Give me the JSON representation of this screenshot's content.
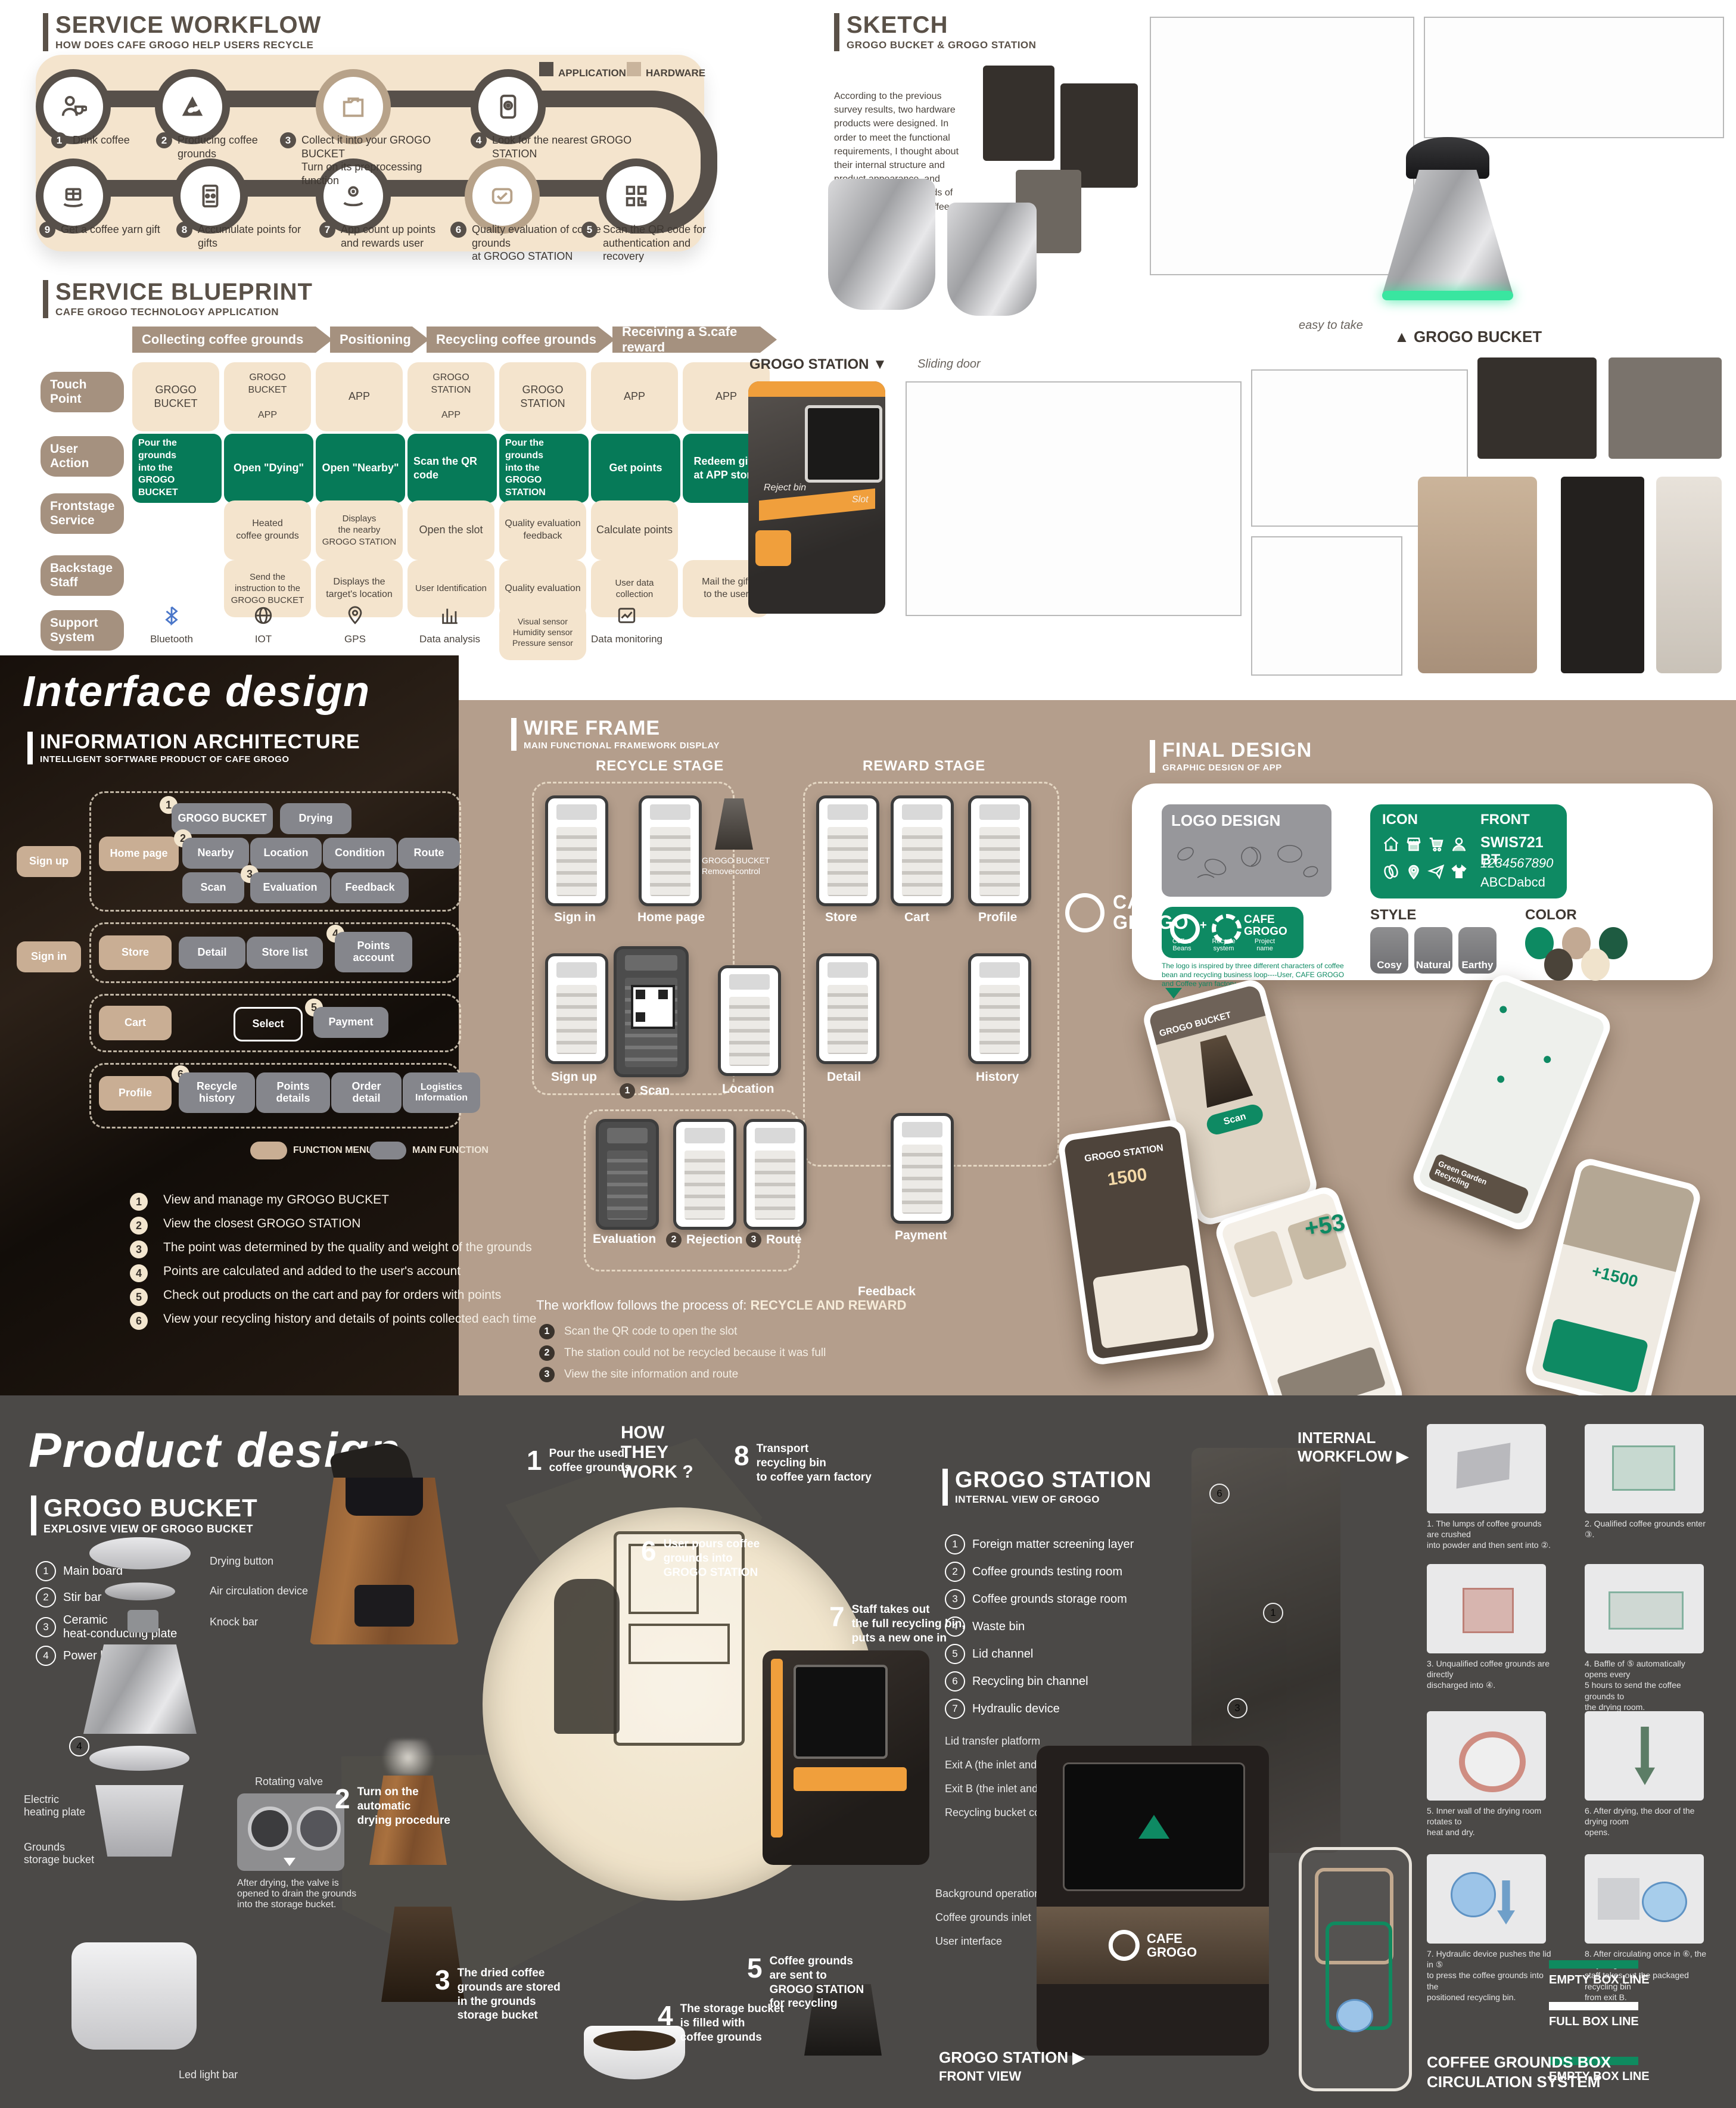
{
  "service_workflow": {
    "title": "SERVICE WORKFLOW",
    "subtitle": "HOW DOES CAFE GROGO HELP USERS RECYCLE",
    "legend": [
      {
        "label": "APPLICATION",
        "color": "#57504a"
      },
      {
        "label": "HARDWARE",
        "color": "#c9b49c"
      }
    ],
    "row1": [
      {
        "num": "1",
        "label": "Drink coffee"
      },
      {
        "num": "2",
        "label": "Producing coffee grounds"
      },
      {
        "num": "3",
        "label": "Collect it into your GROGO BUCKET\nTurn on its preprocessing function"
      },
      {
        "num": "4",
        "label": "Look for the nearest GROGO STATION"
      }
    ],
    "row2": [
      {
        "num": "9",
        "label": "Get a coffee yarn gift"
      },
      {
        "num": "8",
        "label": "Accumulate points for gifts"
      },
      {
        "num": "7",
        "label": "App count up points\nand rewards user"
      },
      {
        "num": "6",
        "label": "Quality evaluation of coffee grounds\nat GROGO STATION"
      },
      {
        "num": "5",
        "label": "Scan the QR code for\nauthentication and recovery"
      }
    ]
  },
  "service_blueprint": {
    "title": "SERVICE BLUEPRINT",
    "subtitle": "CAFE GROGO TECHNOLOGY APPLICATION",
    "phases": [
      "Collecting coffee grounds",
      "Positioning",
      "Recycling coffee grounds",
      "Receiving a S.cafe reward"
    ],
    "rows": [
      "Touch\nPoint",
      "User\nAction",
      "Frontstage\nService",
      "Backstage\nStaff",
      "Support\nSystem"
    ],
    "touch_point": [
      "GROGO\nBUCKET",
      "GROGO\nBUCKET\n\nAPP",
      "APP",
      "GROGO\nSTATION\n\nAPP",
      "GROGO\nSTATION",
      "APP",
      "APP"
    ],
    "user_action": [
      "Pour the grounds\ninto the\nGROGO BUCKET",
      "Open \"Dying\"",
      "Open \"Nearby\"",
      "Scan the QR code",
      "Pour the grounds\ninto the\nGROGO STATION",
      "Get points",
      "Redeem gifts\nat APP store"
    ],
    "frontstage": [
      "Heated\ncoffee grounds",
      "Displays\nthe nearby\nGROGO STATION",
      "Open the slot",
      "Quality evaluation\nfeedback",
      "Calculate points"
    ],
    "backstage": [
      "Send the\ninstruction to the\nGROGO BUCKET",
      "Displays the\ntarget's location",
      "User Identification",
      "Quality evaluation",
      "User data collection",
      "Mail the gift\nto the user"
    ],
    "support": [
      {
        "label": "Bluetooth"
      },
      {
        "label": "IOT"
      },
      {
        "label": "GPS"
      },
      {
        "label": "Data analysis"
      },
      {
        "label": "Visual sensor\nHumidity sensor\nPressure sensor"
      },
      {
        "label": "Data monitoring"
      }
    ]
  },
  "sketch": {
    "title": "SKETCH",
    "subtitle": "GROGO BUCKET & GROGO STATION",
    "paragraph": "According to the previous survey results, two hardware products were designed. In order to meet the functional requirements, I thought about their internal structure and product appearance, and determined their methods of drying and collecting coffee grounds.",
    "bucket_label": "▲  GROGO BUCKET",
    "station_label": "GROGO STATION ▼",
    "easy_to_take": "easy to take",
    "sliding_door": "Sliding door",
    "reject_bin": "Reject bin",
    "slot": "Slot"
  },
  "interface_design": {
    "heading": "Interface  design",
    "ia_title": "INFORMATION ARCHITECTURE",
    "ia_subtitle": "INTELLIGENT SOFTWARE PRODUCT OF CAFE GROGO",
    "nodes": {
      "sign_up": "Sign up",
      "sign_in": "Sign in",
      "home": "Home page",
      "bucket": "GROGO BUCKET",
      "drying": "Drying",
      "nearby": "Nearby",
      "location": "Location",
      "condition": "Condition",
      "route": "Route",
      "scan": "Scan",
      "evaluation": "Evaluation",
      "feedback": "Feedback",
      "store": "Store",
      "detail": "Detail",
      "store_list": "Store list",
      "points_account": "Points\naccount",
      "cart": "Cart",
      "select": "Select",
      "payment": "Payment",
      "profile": "Profile",
      "recycle_history": "Recycle\nhistory",
      "points_details": "Points\ndetails",
      "order_detail": "Order\ndetail",
      "logistics": "Logistics\nInformation"
    },
    "badges": [
      "1",
      "2",
      "3",
      "4",
      "5",
      "6"
    ],
    "legend": [
      {
        "label": "FUNCTION MENU"
      },
      {
        "label": "MAIN FUNCTION"
      }
    ],
    "notes": [
      {
        "num": "1",
        "text": "View and manage my GROGO BUCKET"
      },
      {
        "num": "2",
        "text": "View the closest GROGO STATION"
      },
      {
        "num": "3",
        "text": "The point was determined by the quality and weight of the grounds"
      },
      {
        "num": "4",
        "text": "Points are calculated and added to the user's account"
      },
      {
        "num": "5",
        "text": "Check out products on the cart and pay for orders with points"
      },
      {
        "num": "6",
        "text": "View your recycling history and details of points collected each time"
      }
    ]
  },
  "wireframe": {
    "title": "WIRE FRAME",
    "subtitle": "MAIN FUNCTIONAL FRAMEWORK DISPLAY",
    "recycle_stage": "RECYCLE STAGE",
    "reward_stage": "REWARD STAGE",
    "screens": {
      "sign_in": "Sign in",
      "home": "Home page",
      "sign_up": "Sign up",
      "scan": {
        "num": "1",
        "label": "Scan"
      },
      "location": "Location",
      "evaluation": "Evaluation",
      "rejection": {
        "num": "2",
        "label": "Rejection"
      },
      "route": {
        "num": "3",
        "label": "Route"
      },
      "store": "Store",
      "cart": "Cart",
      "profile": "Profile",
      "detail": "Detail",
      "history": "History",
      "payment": "Payment",
      "feedback": "Feedback"
    },
    "bucket_note": "GROGO BUCKET\nRemove control",
    "process_prefix": "The workflow follows the process of: ",
    "process_bold": "RECYCLE AND REWARD",
    "notes": [
      {
        "num": "1",
        "text": "Scan the QR code to open the slot"
      },
      {
        "num": "2",
        "text": "The station could not be recycled because it was full"
      },
      {
        "num": "3",
        "text": "View the site information and route"
      }
    ]
  },
  "final_design": {
    "title": "FINAL DESIGN",
    "subtitle": "GRAPHIC DESIGN OF APP",
    "logo_design_label": "LOGO DESIGN",
    "icon_label": "ICON",
    "front_label": "FRONT",
    "front_font": "SWIS721 BT",
    "front_digits": "1234567890",
    "front_letters": "ABCDabcd",
    "style_label": "STYLE",
    "styles": [
      "Cosy",
      "Natural",
      "Earthy"
    ],
    "color_label": "COLOR",
    "palette": [
      "#0d8a62",
      "#c2a993",
      "#1e5b41",
      "#4a4339",
      "#f0e3cc"
    ],
    "logo_plus": "+",
    "logo_name": "CAFE\nGROGO",
    "logo_captions": [
      "Coffee\nBeans",
      "Recycle\nsystem",
      "Project\nname"
    ],
    "logo_desc": "The logo is inspired by three different characters of coffee bean and recycling business loop----User, CAFE GROGO and Coffee yarn factory",
    "brand_name": "CAFE\nGROGO",
    "phone_texts": {
      "bucket_card": "GROGO BUCKET",
      "scan_button": "Scan",
      "station_title": "GROGO STATION",
      "points": "1500",
      "plus53": "+53",
      "plus1500": "+1500",
      "green_garden": "Green Garden\nRecycling"
    }
  },
  "product_design": {
    "heading": "Product  design",
    "bucket": {
      "title": "GROGO BUCKET",
      "subtitle": "EXPLOSIVE VIEW OF GROGO BUCKET",
      "parts": [
        {
          "num": "1",
          "label": "Main board"
        },
        {
          "num": "2",
          "label": "Stir bar"
        },
        {
          "num": "3",
          "label": "Ceramic\nheat-conducting plate"
        },
        {
          "num": "4",
          "label": "Power board"
        }
      ],
      "callout_drying": "Drying button",
      "callout_air": "Air circulation device",
      "callout_knock": "Knock bar",
      "callout_heating": "Electric\nheating plate",
      "callout_storage": "Grounds\nstorage bucket",
      "callout_led": "Led light bar",
      "valve_label": "Rotating valve",
      "valve_note": "After drying, the valve is\nopened to drain the grounds\ninto the storage bucket."
    },
    "how": {
      "title": "HOW\nTHEY\nWORK ?",
      "steps": [
        {
          "num": "1",
          "text": "Pour the used\ncoffee grounds"
        },
        {
          "num": "2",
          "text": "Turn on the\nautomatic\ndrying procedure"
        },
        {
          "num": "3",
          "text": "The dried coffee\ngrounds are stored\nin the grounds\nstorage bucket"
        },
        {
          "num": "4",
          "text": "The storage bucket\nis filled with\ncoffee grounds"
        },
        {
          "num": "5",
          "text": "Coffee grounds\nare sent to\nGROGO STATION\nfor recycling"
        },
        {
          "num": "6",
          "text": "User pours coffee\ngrounds into\nGROGO STATION"
        },
        {
          "num": "7",
          "text": "Staff takes out\nthe full recycling bin,\nputs a new one in"
        },
        {
          "num": "8",
          "text": "Transport\nrecycling bin\nto coffee yarn factory"
        }
      ]
    },
    "station": {
      "title": "GROGO STATION",
      "subtitle": "INTERNAL VIEW OF GROGO",
      "items": [
        {
          "num": "1",
          "label": "Foreign matter screening layer"
        },
        {
          "num": "2",
          "label": "Coffee grounds testing room"
        },
        {
          "num": "3",
          "label": "Coffee grounds storage room"
        },
        {
          "num": "4",
          "label": "Waste bin"
        },
        {
          "num": "5",
          "label": "Lid channel"
        },
        {
          "num": "6",
          "label": "Recycling bin channel"
        },
        {
          "num": "7",
          "label": "Hydraulic device"
        }
      ],
      "labels": [
        "Lid transfer platform",
        "Exit A (the inlet and outlet of the cover)",
        "Exit B (the inlet and outlet of the barrel)",
        "Recycling bucket conveyor",
        "Background operation interface",
        "Coffee grounds inlet",
        "User interface"
      ],
      "front_view_title": "GROGO STATION  ▶",
      "front_view_sub": "FRONT VIEW",
      "machine_brand": "CAFE\nGROGO"
    },
    "internal_workflow_label": "INTERNAL\nWORKFLOW  ▶",
    "workflow_steps": [
      "1. The lumps of coffee grounds are crushed\ninto powder and then sent into ②.",
      "2. Qualified coffee grounds enter ③.",
      "3. Unqualified coffee grounds are directly\ndischarged into ④.",
      "4. Baffle of ⑤ automatically opens every\n5 hours to send the coffee grounds to\nthe drying room.",
      "5. Inner wall of the drying room rotates to\nheat and dry.",
      "6. After drying, the door of the drying room\nopens.",
      "7. Hydraulic device pushes the lid in ⑤\nto press the coffee grounds into the\npositioned recycling bin.",
      "8. After circulating once in ⑥, the recycling\nstaff takes out the packaged recycling bin\nfrom exit B."
    ],
    "legend": [
      {
        "label": "EMPTY BOX LINE",
        "color": "#0f8a5f"
      },
      {
        "label": "FULL BOX LINE",
        "color": "#ffffff"
      }
    ],
    "circulation_title": "COFFEE GROUNDS BOX\nCIRCULATION SYSTEM"
  }
}
